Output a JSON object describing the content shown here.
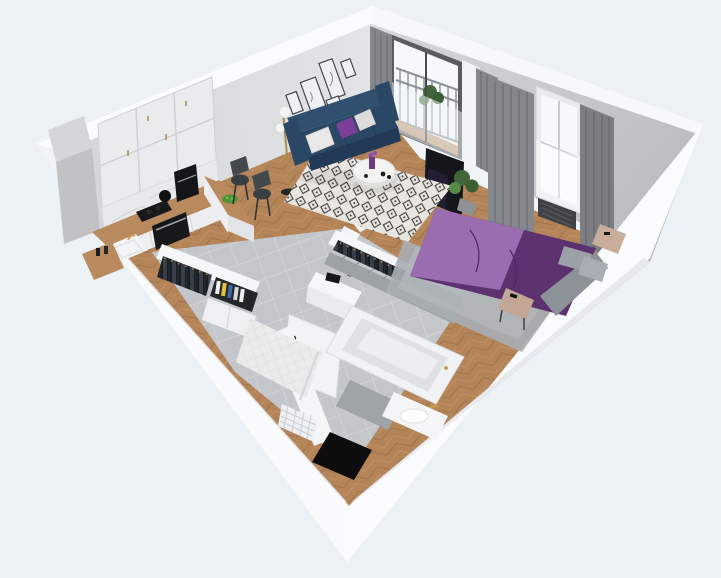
{
  "scene": {
    "title": "3d-apartment-dollhouse-render",
    "view": "isometric-cutaway-top",
    "rooms": [
      {
        "name": "living-room",
        "floor": "herringbone-oak",
        "items": [
          "navy-three-seat-sofa",
          "white-pillows",
          "purple-accent-pillow",
          "round-white-coffee-table",
          "purple-vase",
          "black-white-diamond-rug",
          "brass-floor-lamp-two-globes",
          "gallery-wall-five-frames",
          "balcony-door",
          "gray-curtains",
          "sheer-curtain"
        ]
      },
      {
        "name": "kitchen",
        "floor": "herringbone-oak",
        "items": [
          "white-upper-cabinets-six-doors",
          "marble-backsplash",
          "wood-countertop",
          "induction-cooktop",
          "built-in-oven",
          "white-sink",
          "gold-faucet",
          "coffee-machine",
          "black-kettle",
          "wood-breakfast-bar",
          "two-black-bar-chairs",
          "green-fruit-bowl",
          "concrete-duct-column"
        ]
      },
      {
        "name": "bedroom",
        "floor": "herringbone-oak",
        "items": [
          "double-bed-purple-duvet",
          "light-purple-throw",
          "gray-pillows",
          "gray-crumpled-blanket",
          "gray-shag-rug",
          "beige-nightstand",
          "beige-bench",
          "wall-mounted-tv",
          "window-with-gray-curtains",
          "radiator-under-window",
          "potted-plant",
          "open-wardrobe-hanging-clothes"
        ]
      },
      {
        "name": "bathroom",
        "floor": "gray-tile",
        "items": [
          "bathtub",
          "vanity-sink",
          "gold-faucet",
          "walk-in-shower-white-tile",
          "glass-shower-panel",
          "towel-radiator",
          "gray-floor-mat",
          "black-mat",
          "gray-herringbone-wall-tile"
        ]
      },
      {
        "name": "hallway",
        "floor": "gray-tile",
        "items": [
          "entry-door-with-handle",
          "open-closet-hanging-clothes",
          "shelf-with-books-and-binders",
          "white-base-cabinet",
          "white-console-with-decor"
        ]
      },
      {
        "name": "balcony",
        "floor": "wood-decking",
        "items": [
          "metal-railing",
          "potted-plant"
        ]
      }
    ],
    "palette": {
      "background": "#ecf1f6",
      "shell": "#f1f4f7",
      "wall_top": "#fafbfd",
      "wall_face": "#d3d6d8",
      "wall_face_ne": "#d6d9db",
      "wall_face_ne_dark": "#b7bbbf",
      "wall_shade": "#e3e6e9",
      "floor_wood": "#b5855a",
      "wood_line_dark": "#a1734a",
      "wood_line_light": "#c49065",
      "tile_floor": "#c3c6ca",
      "tile_line": "#d3d6da",
      "rug_base": "#e8e6e1",
      "rug_motif": "#3e3e3c",
      "sofa": "#2b4766",
      "sofa_dark": "#223a57",
      "sofa_light": "#31506f",
      "pillow_white": "#e9e9e9",
      "accent_purple": "#7c3f98",
      "bed_dark": "#5c3170",
      "bed_light": "#9a6cb0",
      "bed_gray": "#8d9298",
      "bed_rug": "#a9aeb3",
      "nightstand": "#c9ad9c",
      "curtain": "#84888c",
      "curtain_dark": "#6e7276",
      "glass": "#f6f9fc",
      "railing": "#8d9296",
      "clothes_dark": "#1a1d21",
      "clothes_mid": "#383f4a",
      "hanger_gold": "#b07f4a",
      "cabinet_white": "#e9ebed",
      "counter_wood": "#b98a5e",
      "marble": "#e8e9eb",
      "appliance_black": "#17181a",
      "steel": "#9aa0a6",
      "plant_green": "#43663a",
      "plant_light": "#578a46",
      "bowl_green": "#4f9433",
      "tub_white": "#f1f2f4",
      "tub_inner": "#dfe2e5",
      "bath_wall_tile": "#9da2a6",
      "mat_dark": "#9fa4a8",
      "mat_black": "#0d0d0e",
      "door_white": "#f2f3f5",
      "lamp_brass": "#ad8a4f",
      "frame_dark": "#44464a",
      "tv_black": "#14161b"
    }
  }
}
